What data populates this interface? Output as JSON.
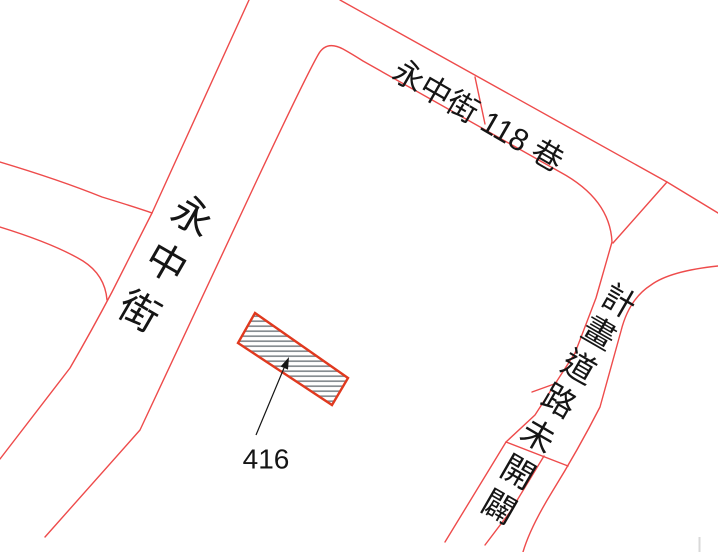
{
  "map": {
    "labels": {
      "street_yongzhong": {
        "full": "永中街",
        "chars": [
          "永",
          "中",
          "街"
        ]
      },
      "lane118": "永中街 118 巷",
      "planned_road": {
        "full": "計畫道路未開闢",
        "chars": [
          "計",
          "畫",
          "道",
          "路",
          "未",
          "開",
          "闢"
        ]
      },
      "parcel_number": "416"
    },
    "colors": {
      "road_line": "#ee4b4b",
      "parcel_border": "#e0391f",
      "hatch_line": "#878d92",
      "label_text": "#151515",
      "artifact_gray": "#d9d9d9"
    }
  }
}
